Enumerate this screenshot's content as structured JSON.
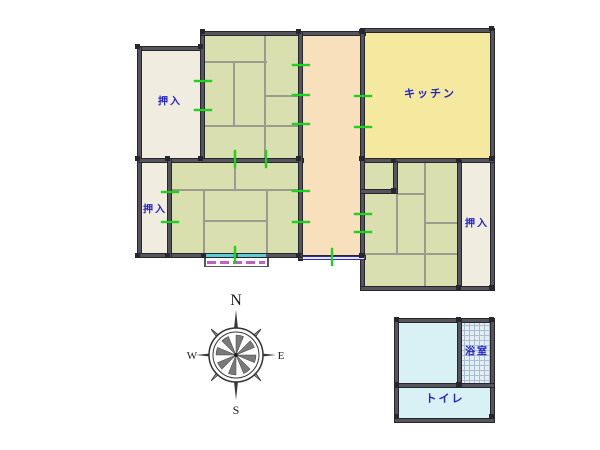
{
  "labels": {
    "oshiire_nw": "押入",
    "oshiire_w": "押入",
    "oshiire_e": "押入",
    "kitchen": "キッチン",
    "bath": "浴室",
    "toilet": "トイレ"
  },
  "compass": {
    "n": "N",
    "s": "S",
    "e": "E",
    "w": "W"
  },
  "colors": {
    "wall": "#55555e",
    "wall_edge": "#26262c",
    "tatami_green": "#d9dfae",
    "closet_beige": "#f0ecdf",
    "hall_peach": "#f8e0bc",
    "kitchen_yellow": "#f5e9a0",
    "wet_cyan": "#d8f1f4",
    "tile_bg": "#e4edf3",
    "tile_line": "#a9bfd0",
    "tatami_line": "#9b9b90",
    "opening_tick": "#1ed31e",
    "window_blue": "#2b2bb4",
    "window_cyan": "#58ccd8",
    "veranda_magenta": "#c45fc4",
    "label_blue": "#2222cc"
  },
  "geometry": {
    "rooms": [
      {
        "id": "closet-nw",
        "fill": "#f0ecdf",
        "rect": [
          140,
          49,
          62,
          111
        ]
      },
      {
        "id": "tatami-north",
        "fill": "#d9dfae",
        "rect": [
          203,
          33,
          99,
          127
        ]
      },
      {
        "id": "hallway",
        "fill": "#f8e0bc",
        "rect": [
          301,
          33,
          62,
          226
        ]
      },
      {
        "id": "hallway-nook",
        "fill": "#f8e0bc",
        "rect": [
          363,
          161,
          34,
          31
        ]
      },
      {
        "id": "kitchen",
        "fill": "#f5e9a0",
        "rect": [
          363,
          31,
          130,
          129
        ]
      },
      {
        "id": "closet-w",
        "fill": "#f0ecdf",
        "rect": [
          140,
          160,
          30,
          95
        ]
      },
      {
        "id": "tatami-center",
        "fill": "#d9dfae",
        "rect": [
          170,
          160,
          131,
          95
        ]
      },
      {
        "id": "tatami-east",
        "fill": "#d9dfae",
        "rect": [
          363,
          160,
          97,
          127
        ]
      },
      {
        "id": "closet-e",
        "fill": "#f0ecdf",
        "rect": [
          459,
          160,
          33,
          127
        ]
      },
      {
        "id": "bath-anteroom",
        "fill": "#d8f1f4",
        "rect": [
          396,
          320,
          65,
          65
        ]
      },
      {
        "id": "bathroom-tile",
        "fill": "tile",
        "tile": true,
        "rect": [
          459,
          320,
          33,
          65
        ]
      },
      {
        "id": "toilet",
        "fill": "#d8f1f4",
        "rect": [
          396,
          385,
          96,
          33
        ]
      }
    ],
    "walls": [
      [
        137,
        46,
        66,
        5
      ],
      [
        137,
        46,
        5,
        212
      ],
      [
        200,
        31,
        5,
        132
      ],
      [
        201,
        31,
        165,
        5
      ],
      [
        362,
        28,
        133,
        5
      ],
      [
        490,
        28,
        5,
        263
      ],
      [
        137,
        158,
        167,
        5
      ],
      [
        360,
        158,
        135,
        5
      ],
      [
        298,
        31,
        5,
        230
      ],
      [
        360,
        28,
        5,
        263
      ],
      [
        298,
        255,
        68,
        5
      ],
      [
        137,
        253,
        166,
        5
      ],
      [
        167,
        158,
        5,
        100
      ],
      [
        393,
        161,
        5,
        33
      ],
      [
        360,
        189,
        38,
        5
      ],
      [
        457,
        160,
        5,
        131
      ],
      [
        360,
        286,
        135,
        5
      ],
      [
        394,
        318,
        101,
        5
      ],
      [
        394,
        318,
        5,
        105
      ],
      [
        490,
        318,
        5,
        105
      ],
      [
        394,
        418,
        101,
        5
      ],
      [
        394,
        383,
        101,
        5
      ],
      [
        457,
        318,
        5,
        70
      ]
    ],
    "tatami_lines": [
      [
        205,
        61,
        62,
        2
      ],
      [
        264,
        36,
        2,
        124
      ],
      [
        266,
        95,
        36,
        2
      ],
      [
        233,
        61,
        2,
        66
      ],
      [
        205,
        125,
        97,
        2
      ],
      [
        171,
        189,
        130,
        2
      ],
      [
        234,
        160,
        2,
        29
      ],
      [
        203,
        191,
        2,
        64
      ],
      [
        266,
        191,
        2,
        64
      ],
      [
        203,
        220,
        63,
        2
      ],
      [
        396,
        194,
        2,
        61
      ],
      [
        424,
        160,
        2,
        95
      ],
      [
        398,
        193,
        26,
        2
      ],
      [
        426,
        222,
        34,
        2
      ],
      [
        363,
        253,
        97,
        2
      ],
      [
        424,
        255,
        2,
        31
      ]
    ],
    "ticks": [
      [
        194,
        80,
        18,
        2
      ],
      [
        194,
        109,
        18,
        2
      ],
      [
        292,
        64,
        18,
        2
      ],
      [
        292,
        94,
        18,
        2
      ],
      [
        292,
        123,
        18,
        2
      ],
      [
        354,
        95,
        18,
        2
      ],
      [
        354,
        126,
        18,
        2
      ],
      [
        161,
        191,
        18,
        2
      ],
      [
        161,
        221,
        18,
        2
      ],
      [
        292,
        190,
        18,
        2
      ],
      [
        292,
        221,
        18,
        2
      ],
      [
        354,
        213,
        18,
        2
      ],
      [
        354,
        231,
        18,
        2
      ],
      [
        234,
        150,
        2,
        18
      ],
      [
        265,
        150,
        2,
        18
      ],
      [
        234,
        246,
        2,
        18
      ],
      [
        331,
        248,
        2,
        18
      ]
    ],
    "nodes": [
      [
        135,
        44
      ],
      [
        198,
        44
      ],
      [
        200,
        29
      ],
      [
        296,
        29
      ],
      [
        359,
        29
      ],
      [
        489,
        26
      ],
      [
        135,
        156
      ],
      [
        165,
        156
      ],
      [
        198,
        156
      ],
      [
        296,
        156
      ],
      [
        359,
        156
      ],
      [
        391,
        158
      ],
      [
        456,
        158
      ],
      [
        489,
        156
      ],
      [
        135,
        253
      ],
      [
        165,
        253
      ],
      [
        201,
        253
      ],
      [
        296,
        253
      ],
      [
        359,
        253
      ],
      [
        391,
        188
      ],
      [
        456,
        285
      ],
      [
        489,
        285
      ],
      [
        394,
        317
      ],
      [
        456,
        317
      ],
      [
        489,
        317
      ],
      [
        394,
        382
      ],
      [
        456,
        382
      ],
      [
        394,
        414
      ],
      [
        489,
        414
      ]
    ],
    "window_blue": [
      303,
      256,
      61,
      4
    ],
    "windows_cyan": [
      [
        206,
        254,
        28,
        3
      ],
      [
        238,
        254,
        28,
        3
      ]
    ],
    "veranda": {
      "edges": [
        [
          204,
          258,
          2,
          9
        ],
        [
          267,
          258,
          2,
          9
        ],
        [
          204,
          266,
          65,
          1
        ]
      ],
      "dash": [
        207,
        261,
        58,
        3
      ]
    },
    "label_marks": [
      {
        "key": "oshiire_nw",
        "x": 170,
        "y": 100,
        "fs": 10
      },
      {
        "key": "oshiire_w",
        "x": 155,
        "y": 208,
        "fs": 10
      },
      {
        "key": "oshiire_e",
        "x": 477,
        "y": 222,
        "fs": 10
      },
      {
        "key": "kitchen",
        "x": 430,
        "y": 93,
        "fs": 11
      },
      {
        "key": "bath",
        "x": 477,
        "y": 350,
        "fs": 10
      },
      {
        "key": "toilet",
        "x": 445,
        "y": 398,
        "fs": 11
      }
    ],
    "compass_box": {
      "x": 184,
      "y": 288,
      "w": 104,
      "h": 132
    }
  }
}
